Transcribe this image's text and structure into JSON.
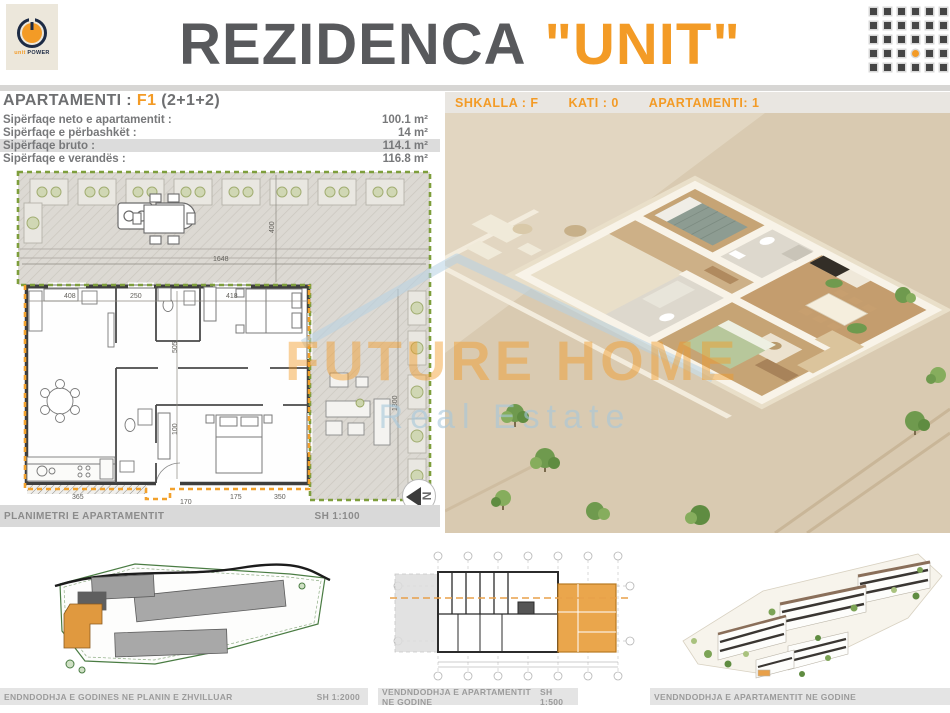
{
  "colors": {
    "accent": "#F39B26",
    "title_gray": "#58595C",
    "caption_gray": "#9B9B9B"
  },
  "logo": {
    "word1": "unit",
    "word2": "POWER"
  },
  "header": {
    "title_main": "REZIDENCA",
    "title_accent": "\"UNIT\""
  },
  "apartment_panel": {
    "title_label": "APARTAMENTI :",
    "title_code": "F1",
    "title_rooms": "(2+1+2)",
    "rows": [
      {
        "label": "Sipërfaqe neto e apartamentit :",
        "value": "100.1 m²"
      },
      {
        "label": "Sipërfaqe e përbashkët :",
        "value": "14 m²"
      },
      {
        "label": "Sipërfaqe bruto :",
        "value": "114.1 m²"
      },
      {
        "label": "Sipërfaqe e verandës :",
        "value": "116.8 m²"
      }
    ],
    "footer": {
      "label": "PLANIMETRI E APARTAMENTIT",
      "scale": "SH 1:100"
    },
    "north_label": "N"
  },
  "render_panel": {
    "header_items": [
      "SHKALLA : F",
      "KATI : 0",
      "APARTAMENTI: 1"
    ]
  },
  "watermark": {
    "line1": "FUTURE HOME",
    "line2": "Real Estate"
  },
  "plan_dimensions": {
    "terrace_width": "1648",
    "terrace_depth": "400",
    "veranda_height": "1300",
    "top": [
      "408",
      "250",
      "418"
    ],
    "left": [
      "505",
      "100"
    ],
    "bottom": [
      "365",
      "170",
      "175",
      "350"
    ]
  },
  "bottom_strip": {
    "captions": [
      {
        "text": "ENDNDODHJA E GODINES NE PLANIN E ZHVILLUAR",
        "scale": "SH 1:2000"
      },
      {
        "text": "VENDNDODHJA E APARTAMENTIT NE GODINE",
        "scale": "SH 1:500"
      },
      {
        "text": "VENDNDODHJA E APARTAMENTIT NE GODINE",
        "scale": ""
      }
    ]
  }
}
